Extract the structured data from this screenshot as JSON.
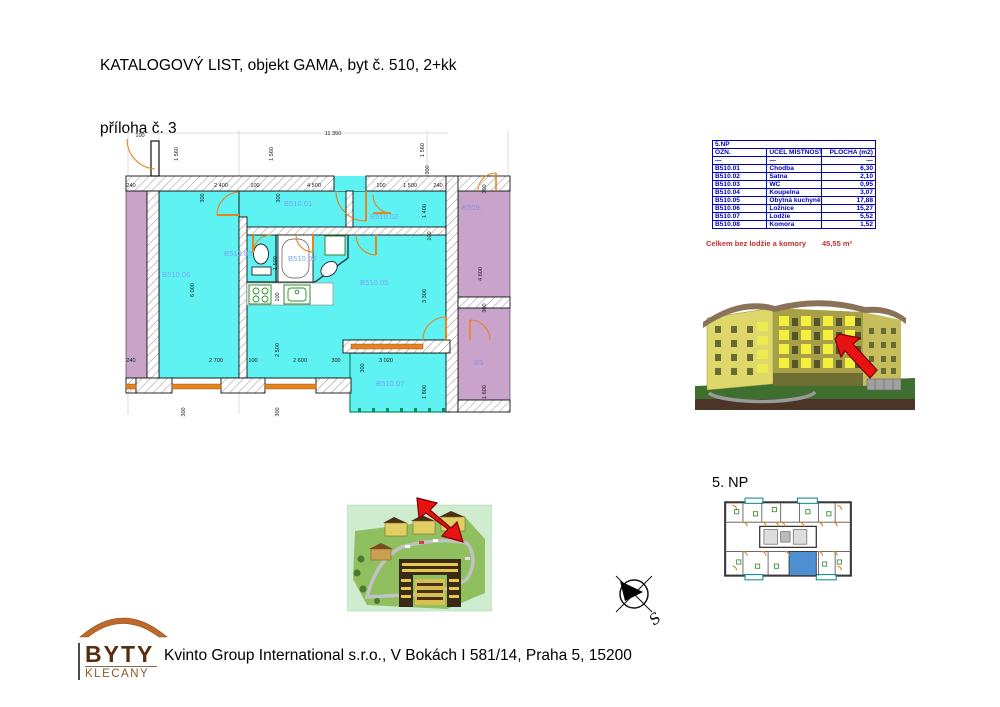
{
  "header": {
    "title_line1": "KATALOGOVÝ LIST, objekt GAMA, byt č. 510, 2+kk",
    "title_line2": "příloha č. 3"
  },
  "room_table": {
    "floor_header": "5.NP",
    "columns": [
      "OZN.",
      "ÚČEL MÍSTNOSTI",
      "PLOCHA (m2)"
    ],
    "rows": [
      {
        "ozn": "—",
        "ucel": "—",
        "plocha": "—"
      },
      {
        "ozn": "B510.01",
        "ucel": "Chodba",
        "plocha": "6,30"
      },
      {
        "ozn": "B510.02",
        "ucel": "Šatna",
        "plocha": "2,10"
      },
      {
        "ozn": "B510.03",
        "ucel": "WC",
        "plocha": "0,95"
      },
      {
        "ozn": "B510.04",
        "ucel": "Koupelna",
        "plocha": "3,07"
      },
      {
        "ozn": "B510.05",
        "ucel": "Obytná kuchyně",
        "plocha": "17,88"
      },
      {
        "ozn": "B510.06",
        "ucel": "Ložnice",
        "plocha": "15,27"
      },
      {
        "ozn": "B510.07",
        "ucel": "Lodžie",
        "plocha": "5,52"
      },
      {
        "ozn": "B510.08",
        "ucel": "Komora",
        "plocha": "1,52"
      }
    ],
    "total_label": "Celkem bez lodžie a komory",
    "total_value": "45,55 m²"
  },
  "floorplan": {
    "room_labels": [
      {
        "t": "B510.01",
        "x": 166,
        "y": 84
      },
      {
        "t": "B510.02",
        "x": 252,
        "y": 97
      },
      {
        "t": "B510.03",
        "x": 106,
        "y": 134
      },
      {
        "t": "B510.04",
        "x": 170,
        "y": 139
      },
      {
        "t": "B510.05",
        "x": 242,
        "y": 163
      },
      {
        "t": "B510.06",
        "x": 44,
        "y": 155
      },
      {
        "t": "B510.07",
        "x": 258,
        "y": 264
      },
      {
        "t": "B509.",
        "x": 344,
        "y": 88,
        "n": true
      },
      {
        "t": "B5",
        "x": 356,
        "y": 243,
        "n": true
      }
    ],
    "dim_labels": [
      {
        "t": "100",
        "x": 22,
        "y": 15
      },
      {
        "t": "11 350",
        "x": 215,
        "y": 13
      },
      {
        "t": "1 560",
        "x": 60,
        "y": 32,
        "r": true
      },
      {
        "t": "1 560",
        "x": 155,
        "y": 32,
        "r": true
      },
      {
        "t": "1 560",
        "x": 306,
        "y": 28,
        "r": true
      },
      {
        "t": "300",
        "x": 311,
        "y": 48,
        "r": true
      },
      {
        "t": "240",
        "x": 13,
        "y": 65
      },
      {
        "t": "2 400",
        "x": 103,
        "y": 65
      },
      {
        "t": "100",
        "x": 137,
        "y": 65
      },
      {
        "t": "4 500",
        "x": 196,
        "y": 65
      },
      {
        "t": "100",
        "x": 263,
        "y": 65
      },
      {
        "t": "1 500",
        "x": 292,
        "y": 65
      },
      {
        "t": "240",
        "x": 320,
        "y": 65
      },
      {
        "t": "300",
        "x": 86,
        "y": 76,
        "r": true
      },
      {
        "t": "300",
        "x": 162,
        "y": 76,
        "r": true
      },
      {
        "t": "300",
        "x": 368,
        "y": 67,
        "r": true
      },
      {
        "t": "1 400",
        "x": 308,
        "y": 89,
        "r": true
      },
      {
        "t": "4 600",
        "x": 364,
        "y": 152,
        "r": true
      },
      {
        "t": "300",
        "x": 368,
        "y": 186,
        "r": true
      },
      {
        "t": "1 600",
        "x": 368,
        "y": 270,
        "r": true
      },
      {
        "t": "6 000",
        "x": 76,
        "y": 168,
        "r": true
      },
      {
        "t": "1 500",
        "x": 159,
        "y": 141,
        "r": true
      },
      {
        "t": "100",
        "x": 161,
        "y": 175,
        "r": true
      },
      {
        "t": "2 500",
        "x": 161,
        "y": 228,
        "r": true
      },
      {
        "t": "100",
        "x": 313,
        "y": 114,
        "r": true
      },
      {
        "t": "3 300",
        "x": 308,
        "y": 174,
        "r": true
      },
      {
        "t": "1 800",
        "x": 308,
        "y": 270,
        "r": true
      },
      {
        "t": "300",
        "x": 246,
        "y": 246,
        "r": true
      },
      {
        "t": "240",
        "x": 13,
        "y": 240
      },
      {
        "t": "2 700",
        "x": 98,
        "y": 240
      },
      {
        "t": "100",
        "x": 135,
        "y": 240
      },
      {
        "t": "2 600",
        "x": 182,
        "y": 240
      },
      {
        "t": "300",
        "x": 218,
        "y": 240
      },
      {
        "t": "3 020",
        "x": 268,
        "y": 240
      },
      {
        "t": "300",
        "x": 67,
        "y": 290,
        "r": true
      },
      {
        "t": "300",
        "x": 161,
        "y": 290,
        "r": true
      }
    ]
  },
  "overview": {
    "floor_label": "5. NP"
  },
  "compass": {
    "label": "S"
  },
  "logo": {
    "line1": "BYTY",
    "line2": "KLECANY"
  },
  "footer": {
    "company": "Kvinto Group International s.r.o., V Bokách I 581/14, Praha 5, 15200"
  },
  "colors": {
    "room_fill": "#5FF2F2",
    "neighbor_fill": "#C9A3C9",
    "door_window_orange": "#E8821E",
    "table_blue": "#0000BB",
    "total_red": "#C03030",
    "arrow_red": "#E81212",
    "room_label_blue": "#79A3F5",
    "loggia_green": "#0a8a5a"
  }
}
